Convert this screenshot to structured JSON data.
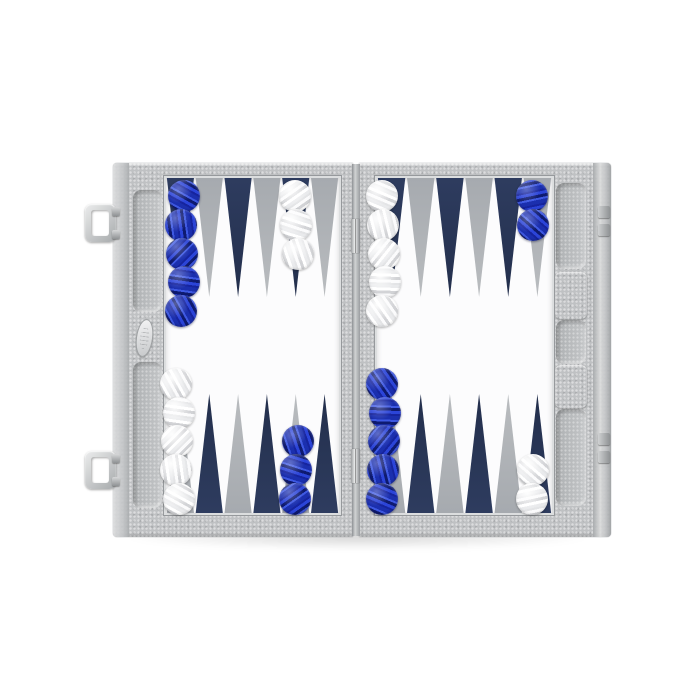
{
  "scene": {
    "type": "product-photo",
    "subject": "open gray leather backgammon case, blue and pearl-white checkers in starting position",
    "background": "#ffffff"
  },
  "colors": {
    "leather": "#bfc1c3",
    "leatherLight": "#d7d9da",
    "leatherDark": "#97999c",
    "field": "#fcfcfd",
    "pointNavy": "#2e3c5f",
    "pointNavyDark": "#232f4c",
    "pointGray": "#a6aaaf",
    "pointGrayLight": "#b9bcbf",
    "checkerBlueA": "#2b44d8",
    "checkerBlueB": "#0e1a70",
    "checkerBlueC": "#3d58e2",
    "checkerWhiteA": "#fbfbfc",
    "checkerWhiteB": "#d2d3d6",
    "metalLight": "#eceded",
    "metal": "#b6b8ba",
    "metalDark": "#85888b"
  },
  "board": {
    "top_points": [
      "navy",
      "gray",
      "navy",
      "gray",
      "navy",
      "gray",
      "navy",
      "gray",
      "navy",
      "gray",
      "navy",
      "gray"
    ],
    "bottom_points": [
      "gray",
      "navy",
      "gray",
      "navy",
      "gray",
      "navy",
      "gray",
      "navy",
      "gray",
      "navy",
      "gray",
      "navy"
    ],
    "stacks": [
      {
        "row": "top",
        "point": 1,
        "color": "blue",
        "count": 5
      },
      {
        "row": "top",
        "point": 5,
        "color": "white",
        "count": 3
      },
      {
        "row": "top",
        "point": 7,
        "color": "white",
        "count": 5
      },
      {
        "row": "top",
        "point": 12,
        "color": "blue",
        "count": 2
      },
      {
        "row": "bottom",
        "point": 1,
        "color": "white",
        "count": 5
      },
      {
        "row": "bottom",
        "point": 5,
        "color": "blue",
        "count": 3
      },
      {
        "row": "bottom",
        "point": 7,
        "color": "blue",
        "count": 5
      },
      {
        "row": "bottom",
        "point": 12,
        "color": "white",
        "count": 2
      }
    ]
  },
  "hardware": {
    "latches_left": 2,
    "catches_right": 2,
    "hinges": 2,
    "brand_plate": 1
  }
}
